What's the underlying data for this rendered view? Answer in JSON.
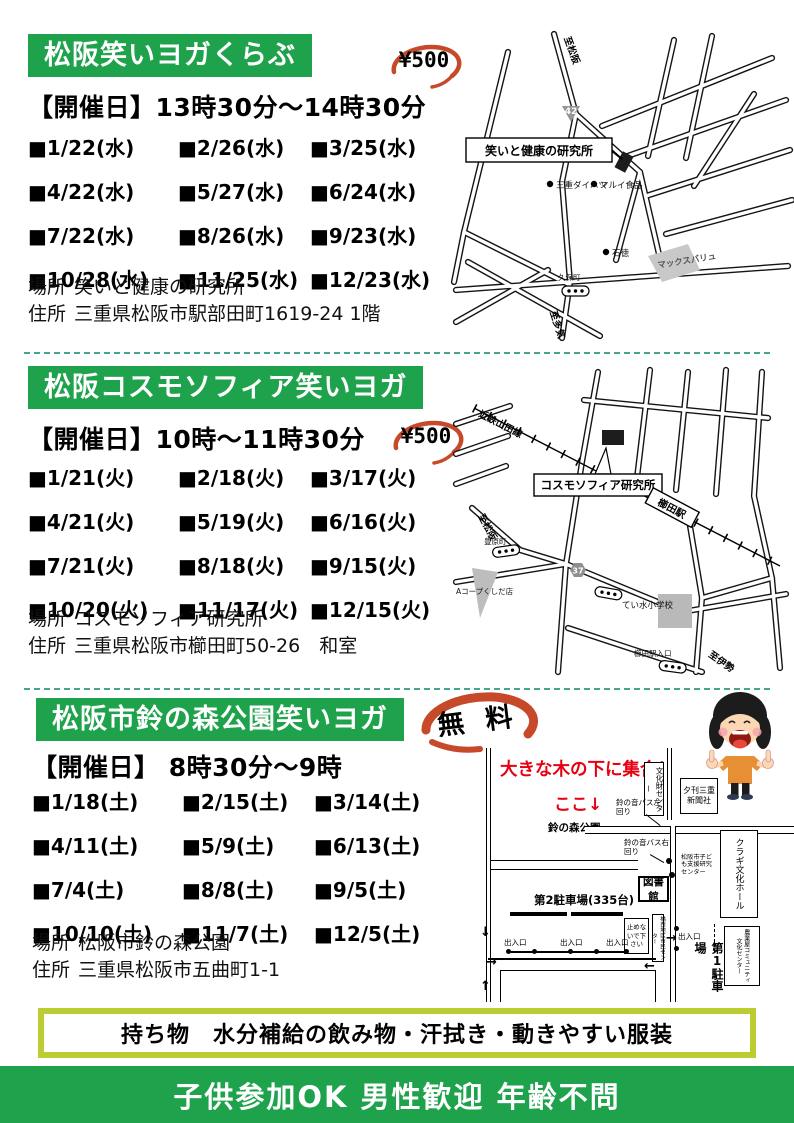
{
  "sections": [
    {
      "title": "松阪笑いヨガくらぶ",
      "price": "¥500",
      "schedule": "【開催日】13時30分～14時30分",
      "dates": [
        "■1/22(水)",
        "■2/26(水)",
        "■3/25(水)",
        "■4/22(水)",
        "■5/27(水)",
        "■6/24(水)",
        "■7/22(水)",
        "■8/26(水)",
        "■9/23(水)",
        "■10/28(水)",
        "■11/25(水)",
        "■12/23(水)"
      ],
      "place_label": "場所",
      "place": "笑いと健康の研究所",
      "address_label": "住所",
      "address": "三重県松阪市駅部田町1619-24 1階",
      "map": {
        "to_top": "至松阪",
        "route": "42",
        "venue": "笑いと健康の研究所",
        "poi1": "三重ダイハツ",
        "poi2": "マルイ食品",
        "poi3": "石徳",
        "bus1": "久保町",
        "store": "マックスバリュ",
        "to_bottom": "至多気"
      }
    },
    {
      "title": "松阪コスモソフィア笑いヨガ",
      "price": "¥500",
      "schedule": "【開催日】10時～11時30分",
      "dates": [
        "■1/21(火)",
        "■2/18(火)",
        "■3/17(火)",
        "■4/21(火)",
        "■5/19(火)",
        "■6/16(火)",
        "■7/21(火)",
        "■8/18(火)",
        "■9/15(火)",
        "■10/20(火)",
        "■11/17(火)",
        "■12/15(火)"
      ],
      "place_label": "場所",
      "place": "コスモソフィア研究所",
      "address_label": "住所",
      "address": "三重県松阪市櫛田町50-26　和室",
      "map": {
        "railway": "近鉄山田線",
        "venue": "コスモソフィア研究所",
        "station": "櫛田駅",
        "to_left": "至松阪",
        "bus1": "豊原町",
        "store": "Aコープくしだ店",
        "route": "37",
        "school": "てい水小学校",
        "bus2": "櫛田駅入口",
        "to_right": "至伊勢"
      }
    },
    {
      "title": "松阪市鈴の森公園笑いヨガ",
      "price": "無 料",
      "schedule": "【開催日】 8時30分～9時",
      "dates": [
        "■1/18(土)",
        "■2/15(土)",
        "■3/14(土)",
        "■4/11(土)",
        "■5/9(土)",
        "■6/13(土)",
        "■7/4(土)",
        "■8/8(土)",
        "■9/5(土)",
        "■10/10(土)",
        "■11/7(土)",
        "■12/5(土)"
      ],
      "place_label": "場所",
      "place": "松阪市鈴の森公園",
      "address_label": "住所",
      "address": "三重県松阪市五曲町1-1",
      "map": {
        "meet": "大きな木の下に集合！",
        "here": "ここ↓",
        "park": "鈴の森公園",
        "bunkazai": "文化財センター",
        "news": "夕刊三重新聞社",
        "bus_left": "鈴の音バス左回り",
        "bus_right": "鈴の音バス右回り",
        "kodomo": "松阪市子ども支援研究センター",
        "kuragi": "クラギ文化ホール",
        "library": "図書館",
        "parking2": "第2駐車場(335台)",
        "dont_park": "止めないで下さい",
        "shimin": "橋西地区市民センター",
        "exit": "出入口",
        "parking1": "第1駐車場",
        "nogyoya": "農業屋コミュニティ文化センター",
        "arrow_down": "↓",
        "arrow_right": "→",
        "arrow_left": "←",
        "arrow_up": "↑"
      }
    }
  ],
  "footer": {
    "belongings": "持ち物　水分補給の飲み物・汗拭き・動きやすい服装",
    "banner": "子供参加OK 男性歓迎 年齢不問"
  },
  "colors": {
    "heading_green": "#1ea24c",
    "badge_red": "#c64a2a",
    "separator_teal": "#46a58d",
    "belongings_border": "#bccd33",
    "map_red_text": "#e60012"
  }
}
